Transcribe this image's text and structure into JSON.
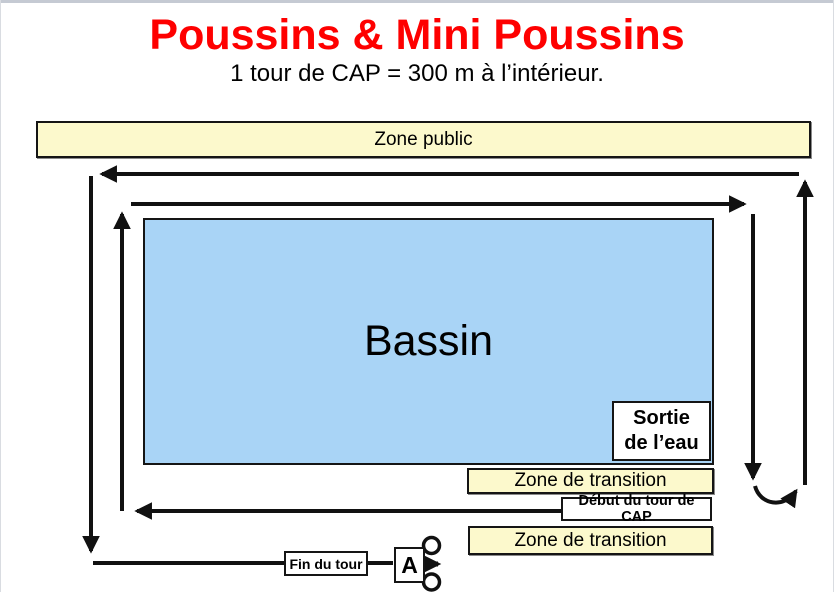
{
  "header": {
    "title": "Poussins & Mini Poussins",
    "subtitle": "1 tour de CAP = 300 m à l’intérieur."
  },
  "zones": {
    "public_label": "Zone public",
    "transition_top_label": "Zone de transition",
    "transition_bottom_label": "Zone de transition"
  },
  "pool": {
    "label": "Bassin"
  },
  "course_markers": {
    "water_exit_line1": "Sortie",
    "water_exit_line2": "de l’eau",
    "cap_lap_start_label": "Début du tour de CAP",
    "lap_end_label": "Fin du tour",
    "point_a_label": "A"
  },
  "colors": {
    "title_red": "#FE0000",
    "zone_yellow": "#FCF9CC",
    "pool_blue": "#A9D4F6",
    "arrow_black": "#111111",
    "top_strip_gray": "#C5CAD3"
  }
}
